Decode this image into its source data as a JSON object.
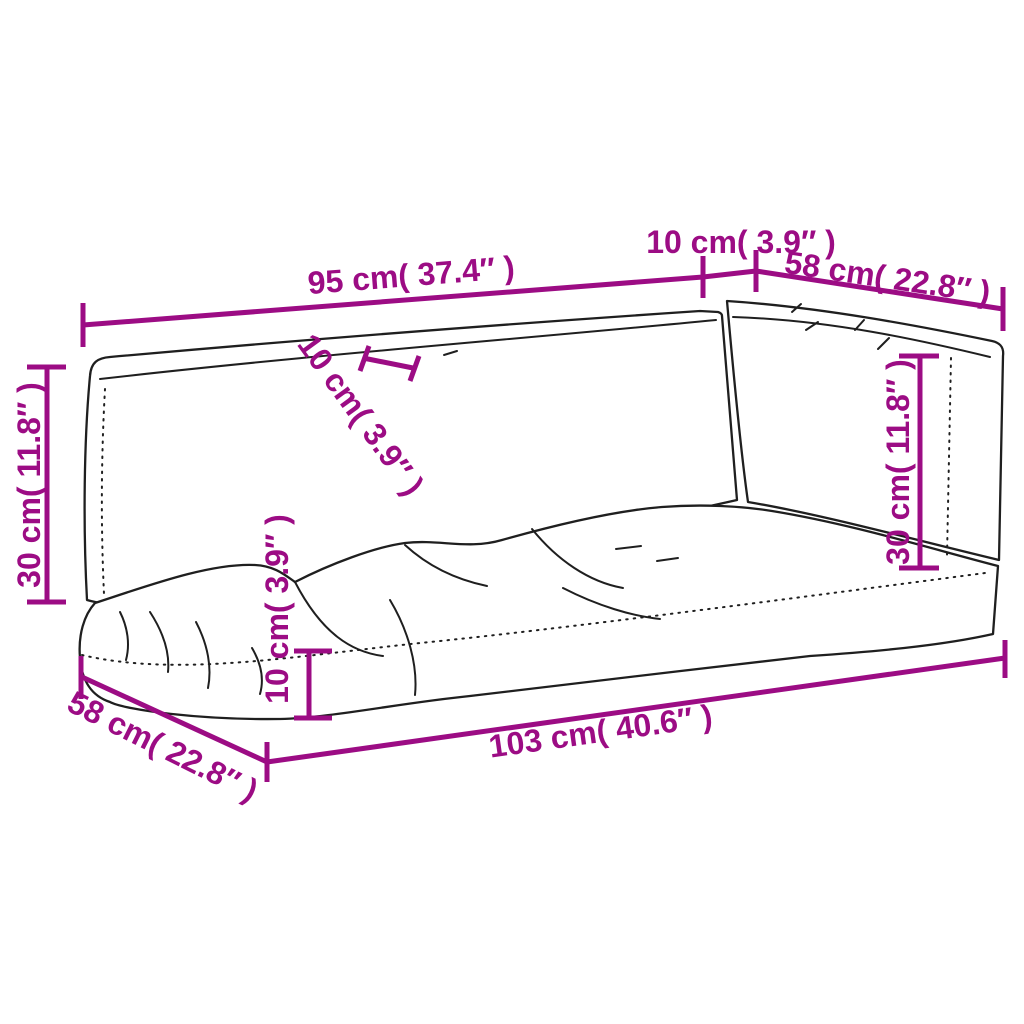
{
  "description": "Line drawing of a three-piece pallet sofa cushion set (seat cushion and two backrest cushions) with dimension annotations",
  "colors": {
    "dimension": "#9c0c84",
    "line": "#1f1f1f",
    "background": "#ffffff"
  },
  "annotations": {
    "top_width": "95 cm( 37.4″ )",
    "top_gap": "10 cm( 3.9″ )",
    "top_right_depth": "58 cm( 22.8″ )",
    "left_height": "30 cm( 11.8″ )",
    "back_thickness": "10 cm( 3.9″ )",
    "right_height": "30 cm( 11.8″ )",
    "seat_thickness": "10 cm( 3.9″ )",
    "bottom_left_depth": "58 cm( 22.8″ )",
    "bottom_length": "103 cm( 40.6″ )"
  }
}
